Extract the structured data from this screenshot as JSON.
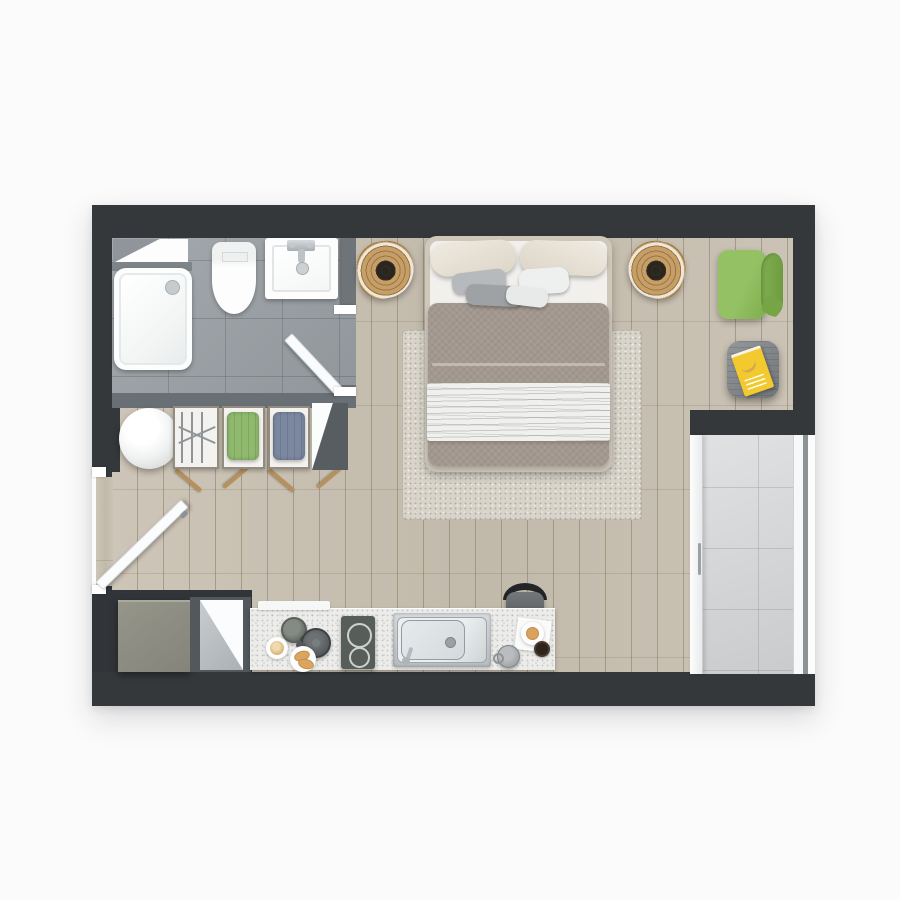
{
  "meta": {
    "title": "Studio apartment floor plan — top-down 3D render",
    "type": "architectural-render",
    "visible_text": "none (magazine cover title illegible)"
  },
  "palette": {
    "bg": "#fbfbfb",
    "wall-dark": "#34383a",
    "wall-mid": "#6e7478",
    "bath-tile": "#9ca2a7",
    "wood": "#c8c0b2",
    "rug": "#d8d4ca",
    "balcony-tile": "#d4d6d7",
    "counter": "#ececea",
    "cabinet": "#8c8c81",
    "green": "#87b757",
    "magazine-yellow": "#f2ca2f",
    "towel-green": "#8fba6d",
    "towel-blue": "#7b88a0",
    "wicker-tan": "#c69e66",
    "duvet-taupe": "#a3988f",
    "bed-frame": "#cfc8ba"
  },
  "rooms": {
    "bathroom": {
      "label": "bathroom",
      "position": "top-left",
      "floor": "grey ceramic tile",
      "items": [
        "shower tray with drain",
        "toilet",
        "wall-hung washbasin with chrome faucet",
        "window ajar in top wall",
        "inward-swinging door"
      ]
    },
    "laundry_nook": {
      "label": "wardrobe / laundry nook",
      "position": "left, below bathroom",
      "items": [
        "round glossy side table",
        "leaning shelf with metal drying rack",
        "shelf cubby with green folded towels",
        "shelf cubby with blue folded towels",
        "grey end panel with mirror wedge"
      ]
    },
    "bedroom_living": {
      "label": "main bedroom / living area",
      "floor": "light grey wood planks",
      "items": [
        "double bed with taupe duvet and white sheet band",
        "two cream pillows",
        "four accent pillows",
        "speckled grey area rug",
        "rattan papasan chair left of bed",
        "rattan papasan chair right of bed",
        "green lounge chair",
        "grey wooden side table",
        "yellow magazine with banana cover"
      ]
    },
    "kitchen": {
      "label": "kitchenette",
      "position": "bottom",
      "items": [
        "olive-grey cabinet block",
        "entrance door with grey/white panel",
        "white terrazzo counter",
        "white shelf board",
        "grey pot",
        "dark kettle",
        "plate with latte",
        "plate with croissants",
        "two-burner cooktop",
        "stainless steel sink with faucet",
        "bar stool with black backrest",
        "white napkin with plate and pastry",
        "espresso cup",
        "grey mug"
      ]
    },
    "balcony": {
      "label": "balcony",
      "position": "bottom-right",
      "floor": "large light grey tiles",
      "items": [
        "sliding glass door with white frame and handle",
        "outer glazing strips"
      ]
    },
    "entrance": {
      "label": "entrance",
      "position": "left wall",
      "items": [
        "open entry door leaf with handle",
        "door stubs"
      ]
    }
  }
}
